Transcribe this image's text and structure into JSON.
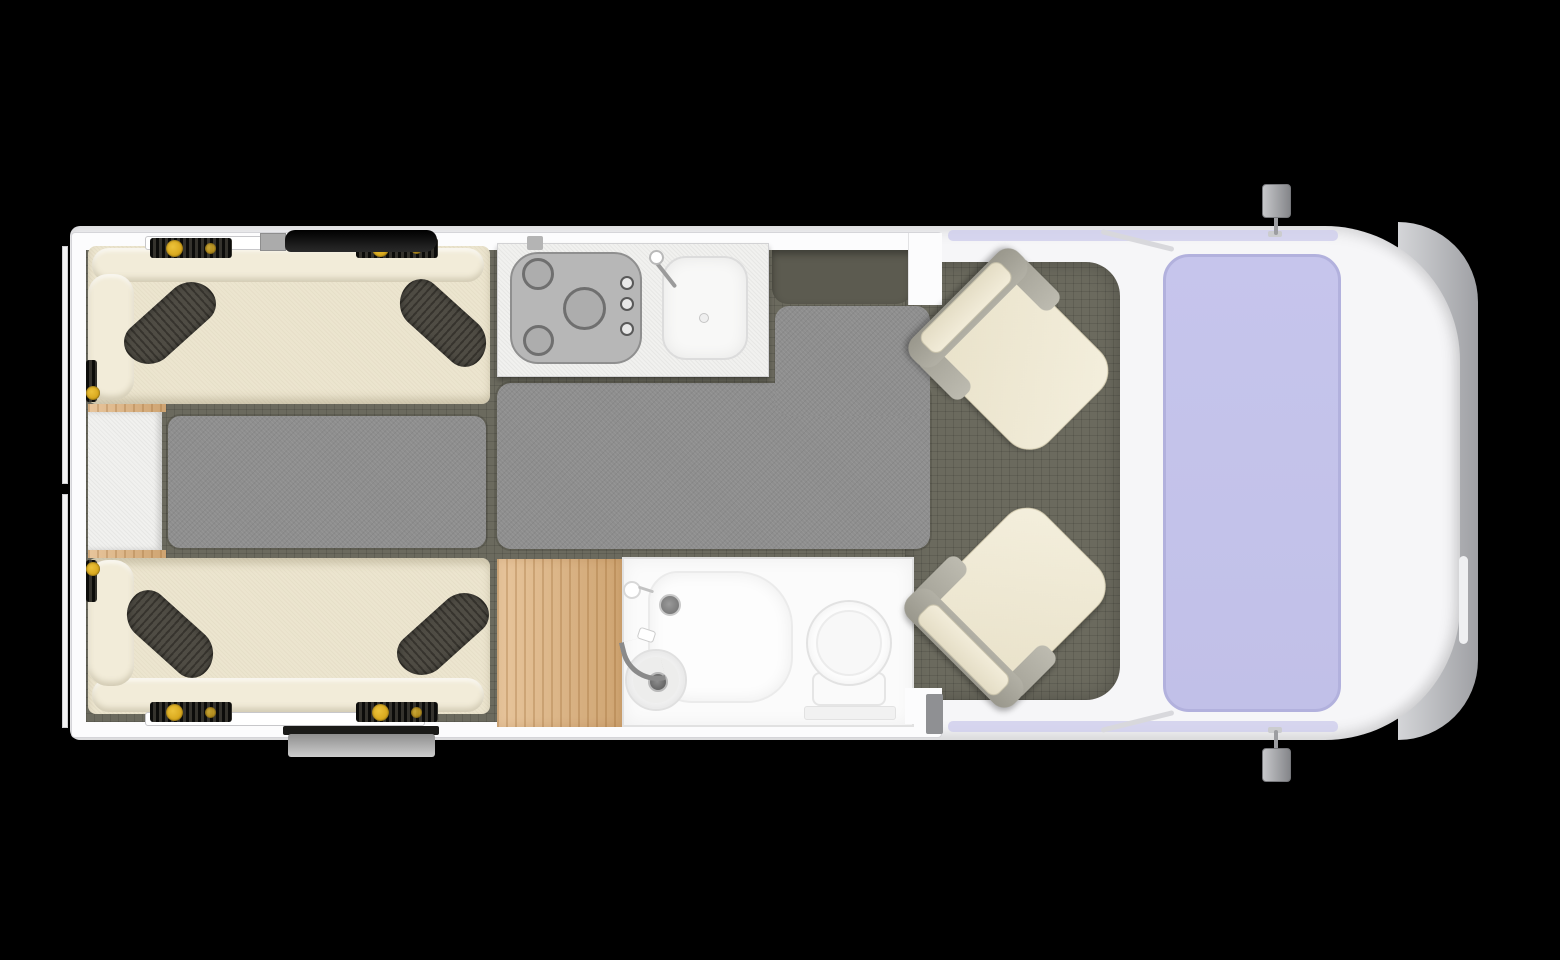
{
  "scene": {
    "title": "Campervan floor plan — top view",
    "view": "overhead interior layout on black background",
    "canvas": {
      "width": 1560,
      "height": 960
    }
  },
  "palette": {
    "background": "#000000",
    "vehicle_body_white": "#f6f6f8",
    "wall_white": "#fcfcfd",
    "floor_olive_gray": "#6b6a5e",
    "entry_recess_dark": "#5c5b50",
    "rug_gray": "#8e8e8e",
    "upholstery_cream": "#ece5cf",
    "pillow_dark_gray": "#4f4c44",
    "seatbelt_yellow": "#d9a91e",
    "worktop_white": "#f1f1ef",
    "hob_gray": "#b7b7b7",
    "cabinet_oak": "#e0b27b",
    "bathroom_white": "#fbfbfb",
    "windshield_lavender": "#c1c0e8",
    "bumper_gray": "#9fa0a4",
    "roof_bar_black": "#161616"
  },
  "areas": {
    "rear_lounge": {
      "items": [
        "bench-seat-top",
        "bench-seat-bottom",
        "cushion-pillow x4",
        "seatbelt-anchors x4",
        "rear-table",
        "floor-rug-left"
      ]
    },
    "kitchen": {
      "items": [
        "worktop",
        "hob-3-burners",
        "hob-knobs x3",
        "sink-basin",
        "faucet"
      ]
    },
    "entry": {
      "items": [
        "door-recess",
        "floor-rug-main"
      ]
    },
    "bathroom": {
      "items": [
        "oak-cabinet",
        "shower-tray",
        "shower-drain",
        "shower-mixer",
        "wash-basin",
        "basin-faucet",
        "toilet"
      ]
    },
    "cab": {
      "items": [
        "swivel-seat-top",
        "swivel-seat-bottom",
        "windshield",
        "side-mirror-top",
        "side-mirror-bottom",
        "front-bumper"
      ]
    },
    "roof_fittings": {
      "items": [
        "roof-vent-bar",
        "roof-vent-box",
        "awning-rail"
      ]
    }
  }
}
